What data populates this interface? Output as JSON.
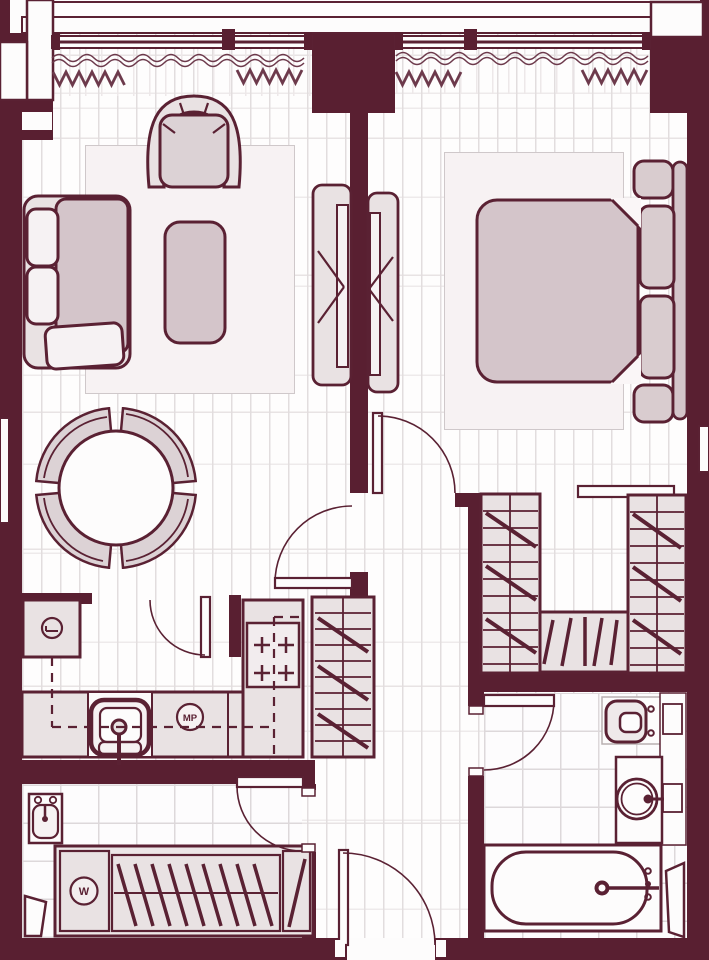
{
  "title": "one-bedroom-apartment-floor-plan",
  "labels": {
    "washer": "W",
    "microwave": "МР"
  },
  "colors": {
    "wall": "#591F31",
    "outline": "#5A2133",
    "floor": "#FDFCFC",
    "furniture_light": "#E9E2E3",
    "furniture_mauve": "#D4C5CA",
    "rug": "#F7F2F3",
    "plank_line": "#E2DDDE",
    "tile_line": "#DDD8DA"
  },
  "rooms": {
    "living_room": [
      "sofa",
      "armchair",
      "coffee-table",
      "rug",
      "tv-unit",
      "dining-table",
      "dining-chairs-x4",
      "window-with-curtains"
    ],
    "bedroom": [
      "double-bed",
      "pillows-x2",
      "headboard",
      "nightstands-x2",
      "rug",
      "tv-unit",
      "window-with-curtains"
    ],
    "kitchen": [
      "refrigerator",
      "counter",
      "sink",
      "microwave",
      "cooktop-4-burner",
      "upper-cabinets-dashed",
      "tall-cabinet"
    ],
    "walk_in_closet": [
      "shelving-left",
      "shelving-right",
      "lower-unit"
    ],
    "bathroom": [
      "toilet",
      "washbasin-counter",
      "bathtub",
      "shelf-niche"
    ],
    "hallway": [
      "washbasin",
      "washing-machine",
      "wardrobe-rail",
      "entrance-door"
    ]
  }
}
